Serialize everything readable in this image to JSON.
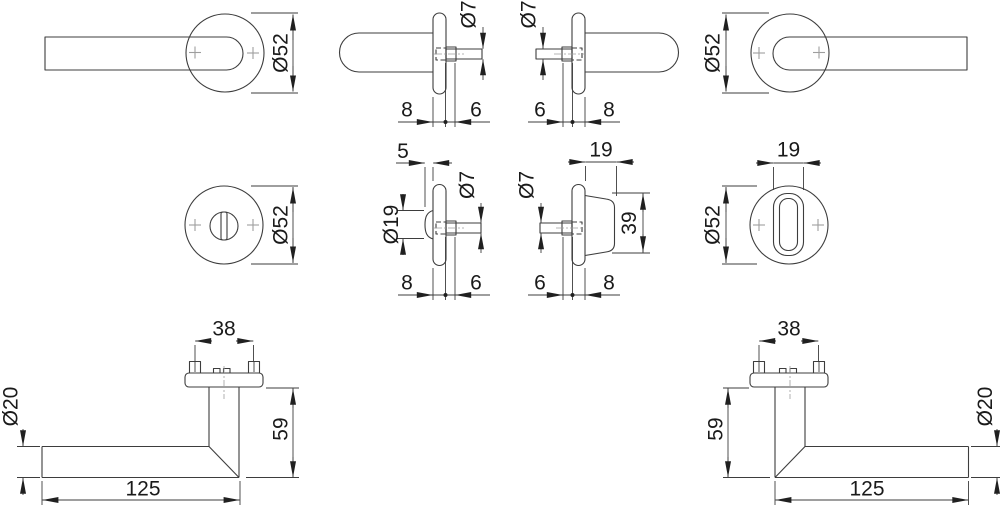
{
  "drawing_title": "Door handle set technical drawing",
  "colors": {
    "background": "#ffffff",
    "line": "#3d3d3d",
    "text": "#1a1a1a",
    "arrow": "#202020",
    "cross": "#9e9e9e",
    "centerline": "#9e9e9e"
  },
  "views": {
    "lever_front_left": {
      "rose_diameter": "Ø52"
    },
    "rose_side_outside": {
      "spindle_diameter": "Ø7",
      "rose_thickness": "8",
      "hub_protrusion": "6"
    },
    "rose_side_inside": {
      "spindle_diameter": "Ø7",
      "hub_protrusion": "6",
      "rose_thickness": "8"
    },
    "lever_front_right": {
      "rose_diameter": "Ø52"
    },
    "wc_rose_front_outside": {
      "rose_diameter": "Ø52"
    },
    "wc_rose_side_outside": {
      "button_protrusion": "5",
      "button_diameter": "Ø19",
      "spindle_diameter": "Ø7",
      "rose_thickness": "8",
      "hub_protrusion": "6"
    },
    "wc_rose_side_inside": {
      "turn_knob_depth": "19",
      "spindle_diameter": "Ø7",
      "turn_knob_height": "39",
      "hub_protrusion": "6",
      "rose_thickness": "8"
    },
    "wc_rose_front_inside": {
      "turn_knob_width": "19",
      "rose_diameter": "Ø52"
    },
    "lever_profile_left": {
      "screw_spacing": "38",
      "grip_diameter": "Ø20",
      "drop_height": "59",
      "lever_length": "125"
    },
    "lever_profile_right": {
      "screw_spacing": "38",
      "drop_height": "59",
      "grip_diameter": "Ø20",
      "lever_length": "125"
    }
  }
}
